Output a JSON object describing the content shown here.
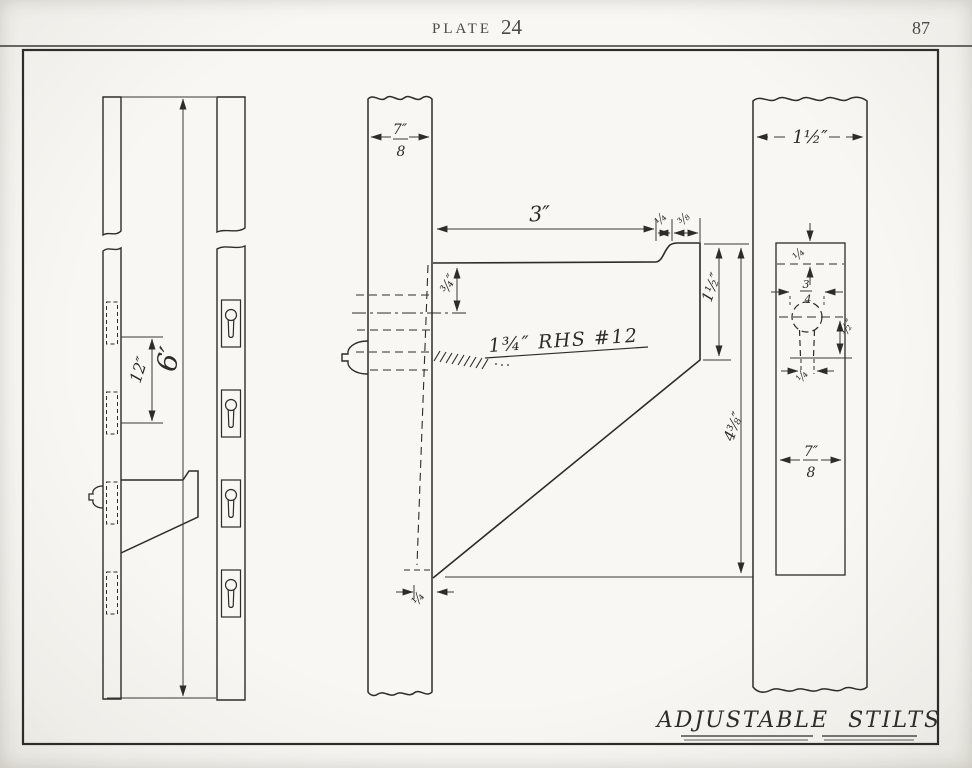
{
  "header": {
    "plate_word": "PLATE",
    "plate_number": "24",
    "page_number": "87"
  },
  "footer": {
    "title": "ADJUSTABLE STILTS"
  },
  "overall_view": {
    "slot_spacing": "12″",
    "pole_length": "6′"
  },
  "side_detail": {
    "pole_width": {
      "num": "7″",
      "den": "8"
    },
    "step_depth": "3″",
    "lip_rise": "¼",
    "lip_width": "⅜",
    "screw_offset": "¾″",
    "screw_note": "1¾″ RHS #12",
    "lip_height": "1½″",
    "bracket_height": "4⅜″",
    "heel_inset": "¼"
  },
  "front_detail": {
    "pole_width": "1½″",
    "slot_top_offset": "¼",
    "hole_diameter": {
      "num": "3",
      "den": "4"
    },
    "slot_length": "½″",
    "slot_width": "¼",
    "plate_width": {
      "num": "7″",
      "den": "8"
    }
  }
}
